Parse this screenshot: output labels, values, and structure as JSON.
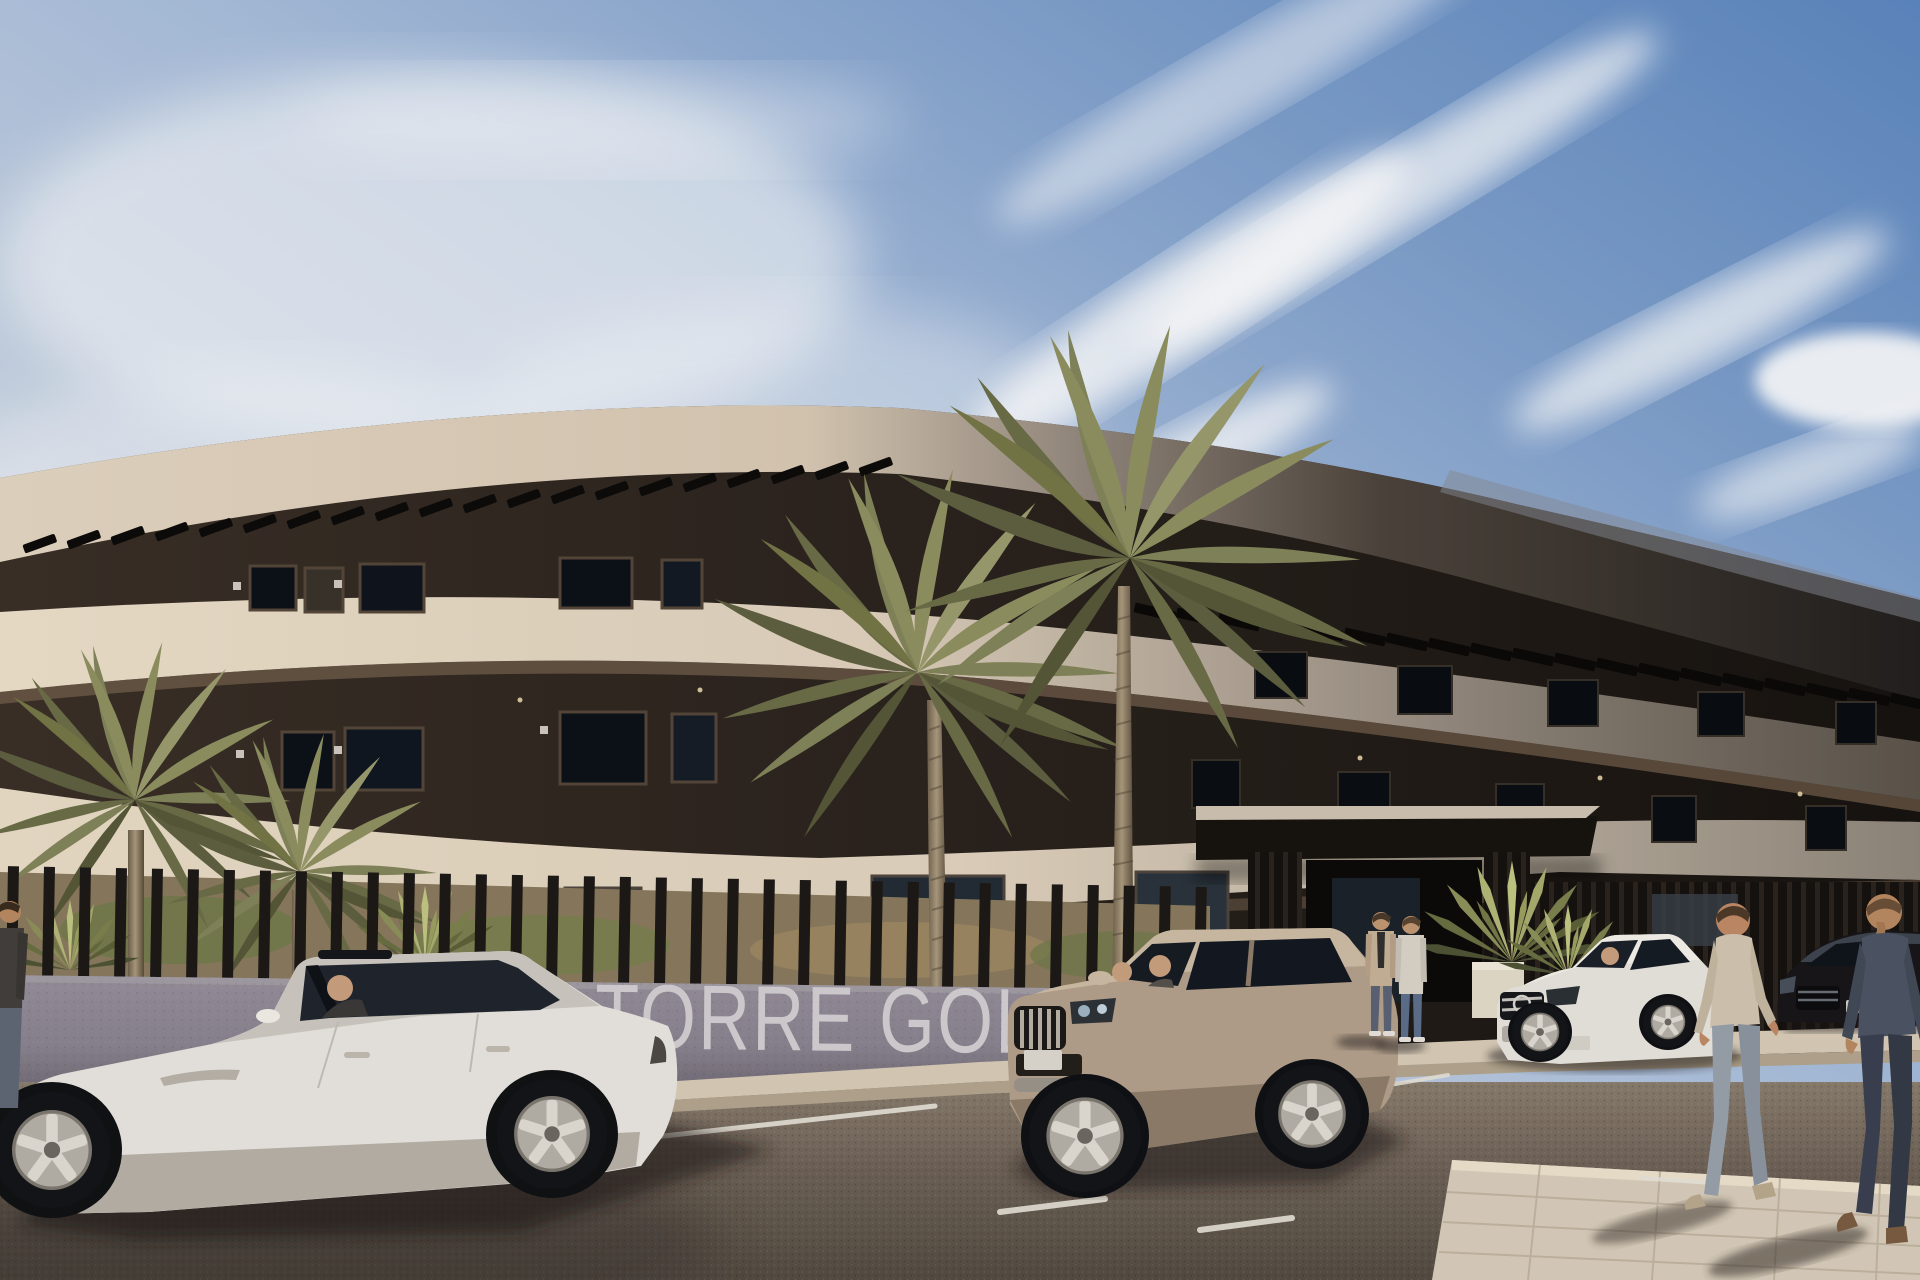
{
  "meta": {
    "title": "Architectural render - Torre Golf residential building exterior",
    "type": "3D exterior visualization"
  },
  "sign": {
    "text": "TORRE GOLF",
    "visible_text": "TORRE GOL",
    "text_color": "#d3ced2",
    "wall_color": "#8e8791"
  },
  "scene": {
    "time_of_day": "day",
    "weather": "sunny with wispy cirrus clouds",
    "objects": [
      {
        "name": "curved-apartment-building",
        "floors": 3,
        "style": "modern cream fascia bands with dark recessed window floors and rooftop pergola slats"
      },
      {
        "name": "entrance-canopy",
        "style": "flat dark canopy on slatted pillars"
      },
      {
        "name": "perimeter-fence",
        "style": "dark vertical slats on low grey wall"
      },
      {
        "name": "sign-wall",
        "text": "TORRE GOLF"
      },
      {
        "name": "palm-tree-tall-center",
        "count": 2
      },
      {
        "name": "palm-cluster-left",
        "count": 2
      },
      {
        "name": "fan-palm-entrance",
        "count": 1
      },
      {
        "name": "white-sedan",
        "color": "#e9e6e0",
        "occupants": 1
      },
      {
        "name": "champagne-suv",
        "color": "#b4a18c",
        "occupants": 2
      },
      {
        "name": "white-mercedes-sedan",
        "color": "#e8e4dd",
        "occupants": 1
      },
      {
        "name": "dark-sedan",
        "color": "#1b1f24"
      },
      {
        "name": "standing-people-entrance",
        "count": 2
      },
      {
        "name": "walking-men-sidewalk",
        "count": 2
      },
      {
        "name": "person-left-edge",
        "count": 1
      }
    ]
  },
  "palette": {
    "sky_deep": "#5d87c0",
    "sky_pale": "#e9eaee",
    "building_cream": "#e6d9c4",
    "building_dark": "#241e19",
    "slab_shadow_grey": "#9a9189",
    "road": "#6e6257",
    "sidewalk": "#d8ccb8",
    "palm_green": "#7f8155",
    "palm_trunk": "#a8977c"
  }
}
